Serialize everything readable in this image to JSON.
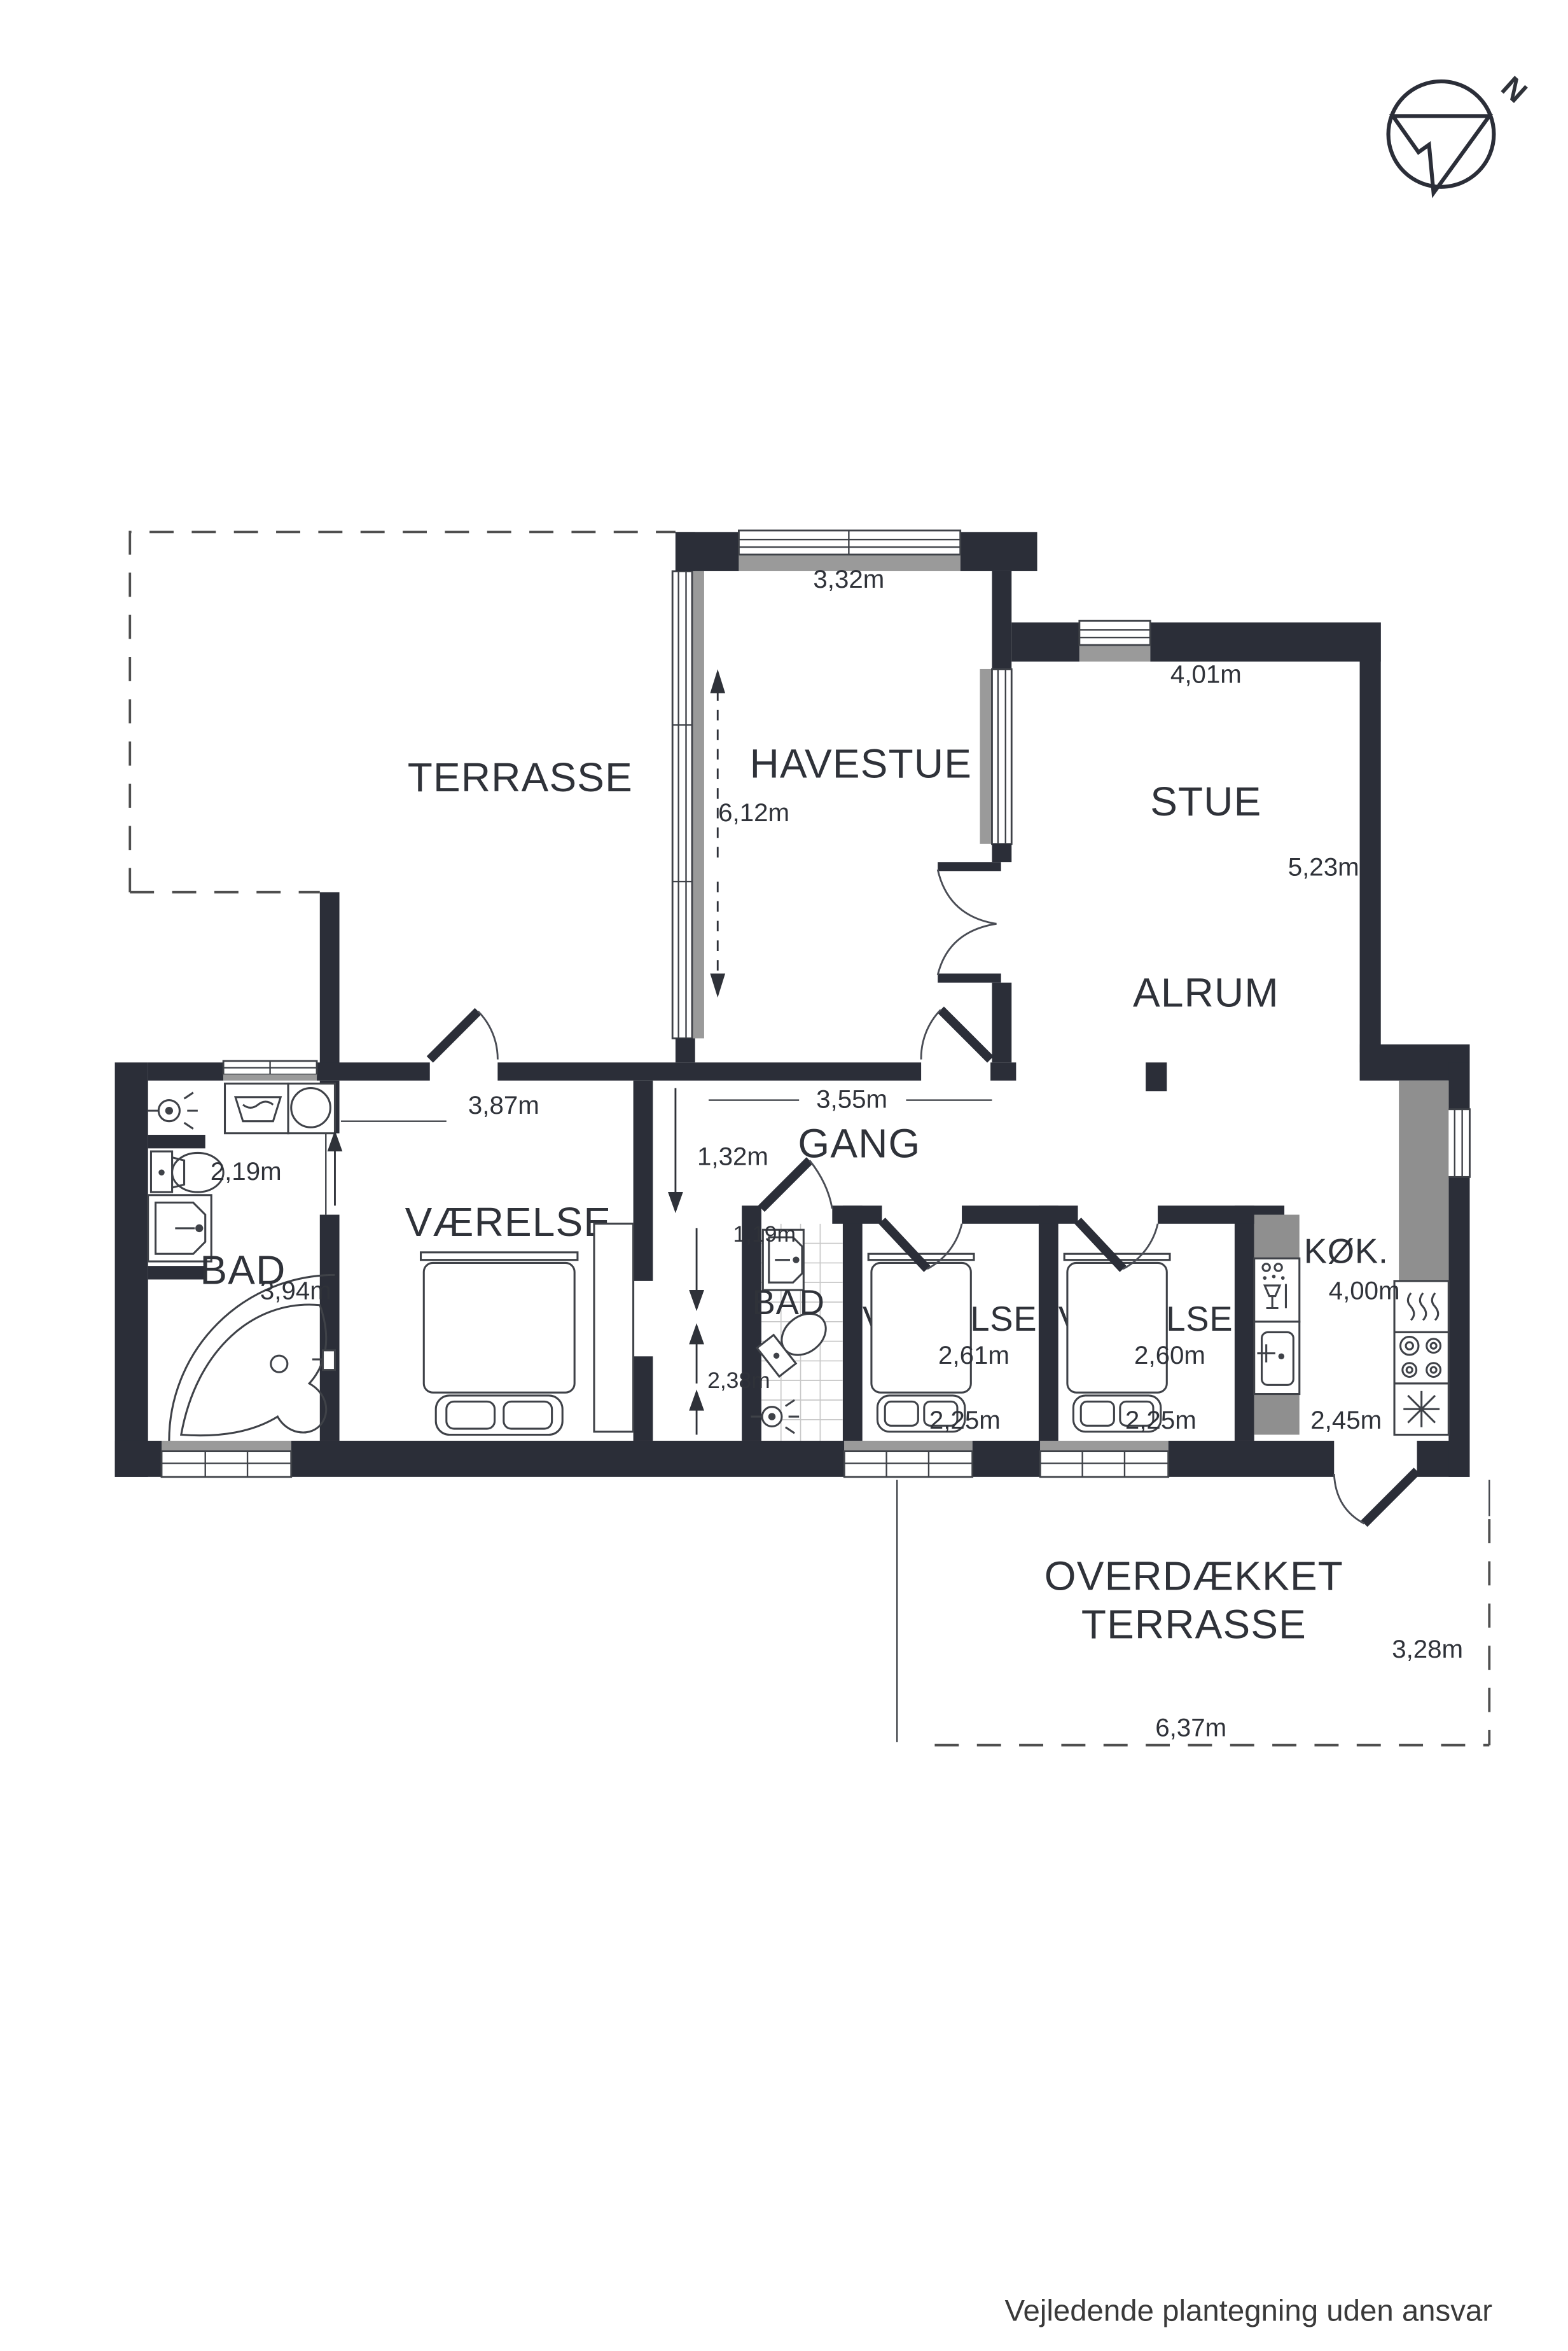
{
  "page": {
    "footer": "Vejledende plantegning uden ansvar"
  },
  "compass": {
    "label": "N"
  },
  "colors": {
    "wall": "#2b2e38",
    "counter_gray": "#8f8f8f",
    "window_gray": "#9a9a9a",
    "background": "#ffffff"
  },
  "rooms": {
    "terrasse": {
      "label": "TERRASSE"
    },
    "havestue": {
      "label": "HAVESTUE",
      "width": "3,32m",
      "depth": "6,12m"
    },
    "stue": {
      "label": "STUE",
      "width": "4,01m",
      "depth": "5,23m"
    },
    "alrum": {
      "label": "ALRUM"
    },
    "gang": {
      "label": "GANG",
      "width": "3,55m",
      "passage": "1,32m"
    },
    "vaerelse_vest": {
      "label": "VÆRELSE",
      "width": "3,87m"
    },
    "bad_vest": {
      "label": "BAD",
      "width": "2,19m",
      "depth": "3,94m"
    },
    "bad_midt": {
      "label": "BAD",
      "width": "1,19m",
      "depth": "2,38m"
    },
    "vaerelse_midt": {
      "label": "VÆRELSE",
      "width": "2,61m",
      "bed": "2,25m"
    },
    "vaerelse_oest": {
      "label": "VÆRELSE",
      "width": "2,60m",
      "bed": "2,25m"
    },
    "koekken": {
      "label": "KØK.",
      "depth": "4,00m",
      "width": "2,45m"
    },
    "overdaekket": {
      "label_line1": "OVERDÆKKET",
      "label_line2": "TERRASSE",
      "depth": "3,28m",
      "width": "6,37m"
    }
  }
}
